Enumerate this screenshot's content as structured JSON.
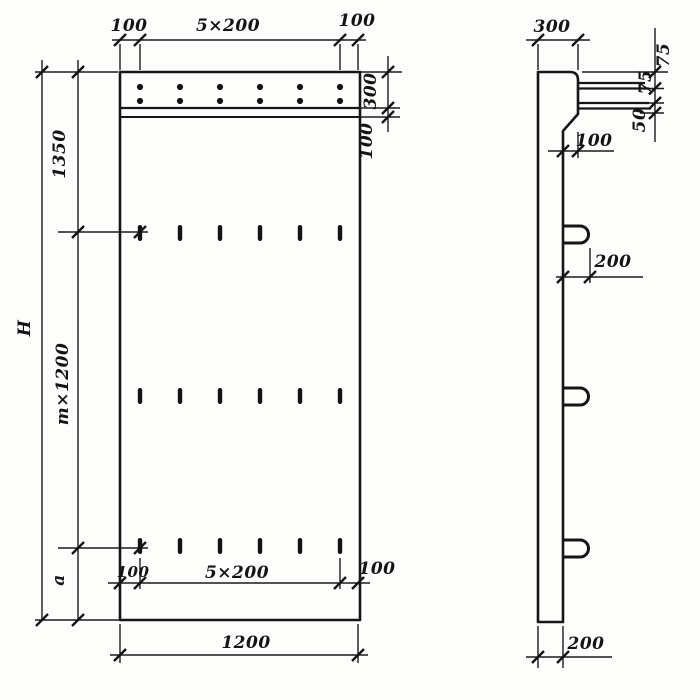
{
  "front_view": {
    "top": {
      "left_100": "100",
      "center_5x200": "5×200",
      "right_100": "100"
    },
    "right": {
      "strip_300": "300",
      "band_100": "100"
    },
    "left": {
      "total_H": "H",
      "upper_1350": "1350",
      "middle_m_1200": "m×1200",
      "bottom_a": "a"
    },
    "inner_bottom": {
      "left_100": "100",
      "center_5x200": "5×200",
      "right_100": "100"
    },
    "bottom": {
      "width_1200": "1200"
    }
  },
  "side_view": {
    "top": {
      "width_300": "300"
    },
    "right": {
      "dim_75_1": "75",
      "dim_75_2": "75",
      "dim_50": "50"
    },
    "step": {
      "offset_100": "100"
    },
    "loop": {
      "length_200": "200"
    },
    "bottom": {
      "thickness_200": "200"
    }
  },
  "ink_color": "#161616",
  "paper_color": "#fdfdfc"
}
